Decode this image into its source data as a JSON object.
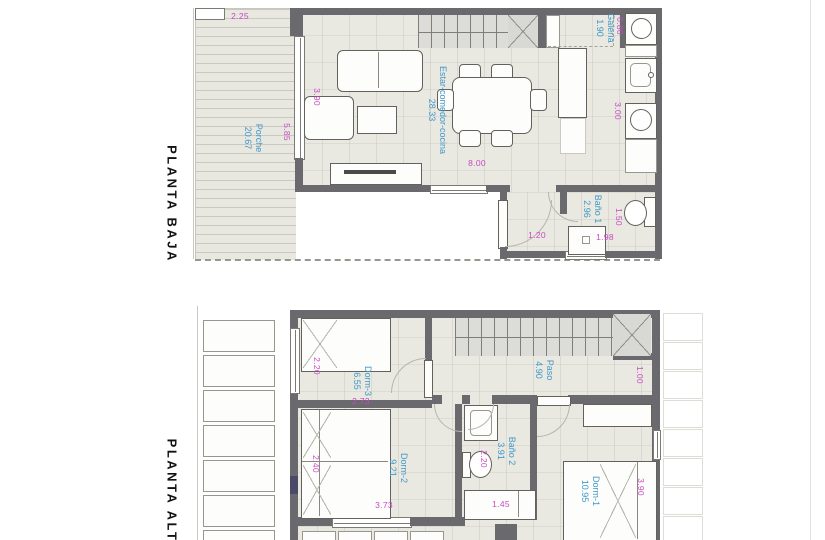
{
  "colors": {
    "wall": "#6a696d",
    "dimension_text": "#c84ac3",
    "room_text": "#3f98c9",
    "floor": "#e9e8e1"
  },
  "pb": {
    "title": "PLANTA BAJA",
    "rooms": {
      "porche": {
        "name": "Porche",
        "area": "20.67"
      },
      "estar": {
        "name": "Estar-comedor-cocina",
        "area": "28.33"
      },
      "galeria": {
        "name": "Galería",
        "area": "1.90"
      },
      "bano1": {
        "name": "Baño 1",
        "area": "2.96"
      }
    },
    "dims": {
      "porch_w": "2.25",
      "door_h": "5.85",
      "salon_w": "3.90",
      "salon_l": "8.00",
      "washer": "0.80",
      "kitchen": "3.00",
      "entry": "1.20",
      "bath_w": "1.50",
      "bath_l": "1.98"
    }
  },
  "pa": {
    "title": "PLANTA ALTA",
    "rooms": {
      "dorm3": {
        "name": "Dorm-3",
        "area": "6.55"
      },
      "dorm2": {
        "name": "Dorm-2",
        "area": "9.21"
      },
      "dorm1": {
        "name": "Dorm-1",
        "area": "10.95"
      },
      "bano2": {
        "name": "Baño 2",
        "area": "3.91"
      },
      "paso": {
        "name": "Paso",
        "area": "4.90"
      }
    },
    "dims": {
      "bed3": "2.20",
      "dorm3_w": "2.73",
      "bed2": "2.40",
      "dorm2_w": "3.73",
      "paso_d": "1.00",
      "wc": "2.20",
      "laundry": "1.45",
      "bed1": "3.90"
    }
  }
}
